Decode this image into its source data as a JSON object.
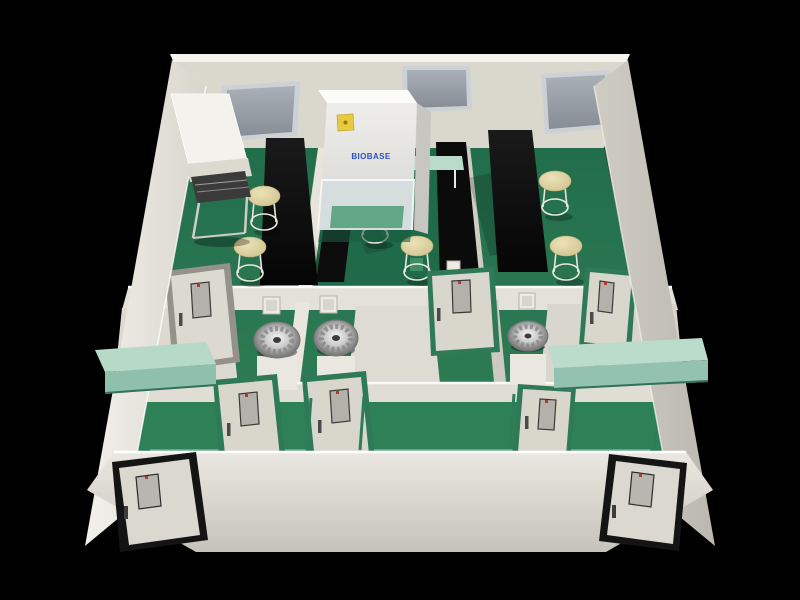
{
  "scene": {
    "title": "3D cutaway render of a laboratory suite with green epoxy floors, white partition walls, black lab benches and biosafety equipment",
    "background_color": "#000000",
    "palette": {
      "wall_cream": "#dedbd2",
      "wall_bright": "#f5f4ef",
      "wall_shadow": "#c6c3ba",
      "floor_green": "#2c7a56",
      "floor_green_dark": "#226e4c",
      "floor_green_light": "#54a176",
      "bench_black": "#0b0b0b",
      "counter_mint": "#b7d9c7",
      "stool_tan": "#ddd2a0",
      "door_face": "#d9d6cc",
      "door_frame_green": "#2e7a57",
      "door_frame_black": "#141414",
      "door_frame_gray": "#94928a",
      "vision_panel_gray": "#b3b1a9",
      "window_glass": "#9aa0a8",
      "window_frame": "#ccd1d6",
      "fan_silver": "#c9c9c9",
      "cabinet_white": "#f0efeb",
      "brand_blue": "#2a4fc4",
      "sticker_yellow": "#e7ca3e",
      "door_dot_red": "#b03a2e"
    },
    "biosafety_cabinet": {
      "brand_label": "BIOBASE",
      "sticker": "biohazard-warning-label",
      "sticker_color": "#e7ca3e"
    },
    "counts": {
      "back_lab_rooms": 3,
      "stools": 6,
      "fan_units": 3,
      "windows": 3,
      "pass_boxes": 4,
      "black_benches": 4,
      "mint_counters": 2,
      "green_top_benches": 1,
      "workstations": 1
    },
    "doors": {
      "black_frame_entry": 2,
      "green_frame_interior": 5,
      "gray_frame_interior": 1,
      "total": 8
    }
  }
}
